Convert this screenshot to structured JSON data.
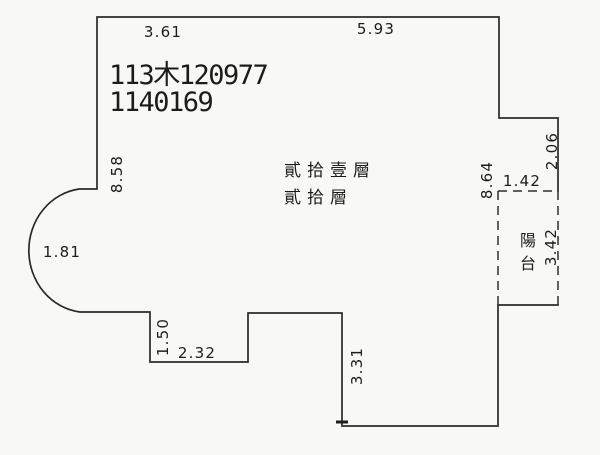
{
  "document": {
    "background": "#f8f8f5",
    "ink": "#2a2a2a",
    "case_number": "113木120977",
    "doc_number": "1140169"
  },
  "floor_labels": {
    "line1": "貳拾壹層",
    "line2": "貳拾層"
  },
  "balcony": {
    "chars": [
      "陽",
      "台"
    ],
    "width": "1.42",
    "depth": "3.42"
  },
  "dimensions": {
    "top_left": "3.61",
    "top_right": "5.93",
    "left_wall": "8.58",
    "right_wall": "8.64",
    "right_upper": "2.06",
    "bay_window": "1.81",
    "notch_depth": "1.50",
    "notch_width": "2.32",
    "lower_right": "3.31"
  }
}
